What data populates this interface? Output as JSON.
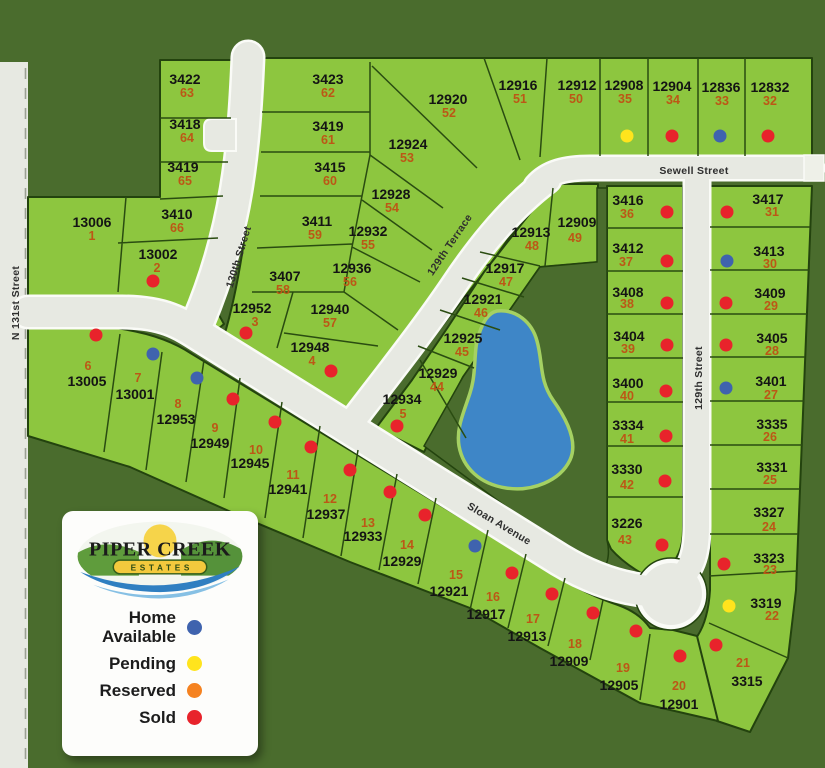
{
  "legend": {
    "brand_top": "PIPER CREEK",
    "brand_banner": "ESTATES",
    "items": [
      {
        "label": "Home Available",
        "status": "home_available",
        "color": "#3f63ae"
      },
      {
        "label": "Pending",
        "status": "pending",
        "color": "#ffe41d"
      },
      {
        "label": "Reserved",
        "status": "reserved",
        "color": "#f58220"
      },
      {
        "label": "Sold",
        "status": "sold",
        "color": "#e8232b"
      }
    ]
  },
  "map": {
    "background_color": "#4a6c2d",
    "lot_color": "#8dc63f",
    "road_color": "#e7e9e2",
    "road_edge_color": "#fafbf7",
    "pond_color": "#3e86c7",
    "address_color": "#141414",
    "lot_number_color": "#bc5716",
    "status_colors": {
      "home_available": "#3f63ae",
      "pending": "#ffe41d",
      "reserved": "#f58220",
      "sold": "#e8232b"
    },
    "streets": [
      {
        "name": "N 131st Street",
        "x": 16,
        "y": 303,
        "rotate": -90
      },
      {
        "name": "130th Street",
        "x": 239,
        "y": 257,
        "rotate": -73
      },
      {
        "name": "129th Terrace",
        "x": 450,
        "y": 245,
        "rotate": -56
      },
      {
        "name": "Sewell Street",
        "x": 694,
        "y": 171,
        "rotate": 0
      },
      {
        "name": "129th Street",
        "x": 699,
        "y": 378,
        "rotate": -90
      },
      {
        "name": "Sloan Avenue",
        "x": 499,
        "y": 524,
        "rotate": 31
      }
    ],
    "lots": [
      {
        "address": "3422",
        "lot": "63",
        "status": null,
        "ax": 185,
        "ay": 79,
        "nx": 187,
        "ny": 93
      },
      {
        "address": "3418",
        "lot": "64",
        "status": null,
        "ax": 185,
        "ay": 124,
        "nx": 187,
        "ny": 138
      },
      {
        "address": "3419",
        "lot": "65",
        "status": null,
        "ax": 183,
        "ay": 167,
        "nx": 185,
        "ny": 181
      },
      {
        "address": "3410",
        "lot": "66",
        "status": null,
        "ax": 177,
        "ay": 214,
        "nx": 177,
        "ny": 228
      },
      {
        "address": "13006",
        "lot": "1",
        "status": null,
        "ax": 92,
        "ay": 222,
        "nx": 92,
        "ny": 236
      },
      {
        "address": "13002",
        "lot": "2",
        "status": "sold",
        "ax": 158,
        "ay": 254,
        "nx": 157,
        "ny": 268,
        "dx": 153,
        "dy": 281
      },
      {
        "address": "3423",
        "lot": "62",
        "status": null,
        "ax": 328,
        "ay": 79,
        "nx": 328,
        "ny": 93
      },
      {
        "address": "3419",
        "lot": "61",
        "status": null,
        "ax": 328,
        "ay": 126,
        "nx": 328,
        "ny": 140
      },
      {
        "address": "3415",
        "lot": "60",
        "status": null,
        "ax": 330,
        "ay": 167,
        "nx": 330,
        "ny": 181
      },
      {
        "address": "3411",
        "lot": "59",
        "status": null,
        "ax": 317,
        "ay": 221,
        "nx": 315,
        "ny": 235
      },
      {
        "address": "3407",
        "lot": "58",
        "status": null,
        "ax": 285,
        "ay": 276,
        "nx": 283,
        "ny": 290
      },
      {
        "address": "12952",
        "lot": "3",
        "status": "sold",
        "ax": 252,
        "ay": 308,
        "nx": 255,
        "ny": 322,
        "dx": 246,
        "dy": 333
      },
      {
        "address": "12940",
        "lot": "57",
        "status": null,
        "ax": 330,
        "ay": 309,
        "nx": 330,
        "ny": 323
      },
      {
        "address": "12948",
        "lot": "4",
        "status": "sold",
        "ax": 310,
        "ay": 347,
        "nx": 312,
        "ny": 361,
        "dx": 331,
        "dy": 371
      },
      {
        "address": "12936",
        "lot": "56",
        "status": null,
        "ax": 352,
        "ay": 268,
        "nx": 350,
        "ny": 282
      },
      {
        "address": "12932",
        "lot": "55",
        "status": null,
        "ax": 368,
        "ay": 231,
        "nx": 368,
        "ny": 245
      },
      {
        "address": "12928",
        "lot": "54",
        "status": null,
        "ax": 391,
        "ay": 194,
        "nx": 392,
        "ny": 208
      },
      {
        "address": "12924",
        "lot": "53",
        "status": null,
        "ax": 408,
        "ay": 144,
        "nx": 407,
        "ny": 158
      },
      {
        "address": "12920",
        "lot": "52",
        "status": null,
        "ax": 448,
        "ay": 99,
        "nx": 449,
        "ny": 113
      },
      {
        "address": "12916",
        "lot": "51",
        "status": null,
        "ax": 518,
        "ay": 85,
        "nx": 520,
        "ny": 99
      },
      {
        "address": "12912",
        "lot": "50",
        "status": null,
        "ax": 577,
        "ay": 85,
        "nx": 576,
        "ny": 99
      },
      {
        "address": "12908",
        "lot": "35",
        "status": "pending",
        "ax": 624,
        "ay": 85,
        "nx": 625,
        "ny": 99,
        "dx": 627,
        "dy": 136
      },
      {
        "address": "12904",
        "lot": "34",
        "status": "sold",
        "ax": 672,
        "ay": 86,
        "nx": 673,
        "ny": 100,
        "dx": 672,
        "dy": 136
      },
      {
        "address": "12836",
        "lot": "33",
        "status": "home_available",
        "ax": 721,
        "ay": 87,
        "nx": 722,
        "ny": 101,
        "dx": 720,
        "dy": 136
      },
      {
        "address": "12832",
        "lot": "32",
        "status": "sold",
        "ax": 770,
        "ay": 87,
        "nx": 770,
        "ny": 101,
        "dx": 768,
        "dy": 136
      },
      {
        "address": "12913",
        "lot": "48",
        "status": null,
        "ax": 531,
        "ay": 232,
        "nx": 532,
        "ny": 246
      },
      {
        "address": "12909",
        "lot": "49",
        "status": null,
        "ax": 577,
        "ay": 222,
        "nx": 575,
        "ny": 238
      },
      {
        "address": "12917",
        "lot": "47",
        "status": null,
        "ax": 505,
        "ay": 268,
        "nx": 506,
        "ny": 282
      },
      {
        "address": "12921",
        "lot": "46",
        "status": null,
        "ax": 483,
        "ay": 299,
        "nx": 481,
        "ny": 313
      },
      {
        "address": "12925",
        "lot": "45",
        "status": null,
        "ax": 463,
        "ay": 338,
        "nx": 462,
        "ny": 352
      },
      {
        "address": "12929",
        "lot": "44",
        "status": null,
        "ax": 438,
        "ay": 373,
        "nx": 437,
        "ny": 387
      },
      {
        "address": "12934",
        "lot": "5",
        "status": "sold",
        "ax": 402,
        "ay": 399,
        "nx": 403,
        "ny": 414,
        "dx": 397,
        "dy": 426
      },
      {
        "address": "3416",
        "lot": "36",
        "status": "sold",
        "ax": 628,
        "ay": 200,
        "nx": 627,
        "ny": 214,
        "dx": 667,
        "dy": 212
      },
      {
        "address": "3412",
        "lot": "37",
        "status": "sold",
        "ax": 628,
        "ay": 248,
        "nx": 626,
        "ny": 262,
        "dx": 667,
        "dy": 261
      },
      {
        "address": "3408",
        "lot": "38",
        "status": "sold",
        "ax": 628,
        "ay": 292,
        "nx": 627,
        "ny": 304,
        "dx": 667,
        "dy": 303
      },
      {
        "address": "3404",
        "lot": "39",
        "status": "sold",
        "ax": 629,
        "ay": 336,
        "nx": 628,
        "ny": 349,
        "dx": 667,
        "dy": 345
      },
      {
        "address": "3400",
        "lot": "40",
        "status": "sold",
        "ax": 628,
        "ay": 383,
        "nx": 627,
        "ny": 396,
        "dx": 666,
        "dy": 391
      },
      {
        "address": "3334",
        "lot": "41",
        "status": "sold",
        "ax": 628,
        "ay": 425,
        "nx": 627,
        "ny": 439,
        "dx": 666,
        "dy": 436
      },
      {
        "address": "3330",
        "lot": "42",
        "status": "sold",
        "ax": 627,
        "ay": 469,
        "nx": 627,
        "ny": 485,
        "dx": 665,
        "dy": 481
      },
      {
        "address": "3226",
        "lot": "43",
        "status": "sold",
        "ax": 627,
        "ay": 523,
        "nx": 625,
        "ny": 540,
        "dx": 662,
        "dy": 545
      },
      {
        "address": "3417",
        "lot": "31",
        "status": "sold",
        "ax": 768,
        "ay": 199,
        "nx": 772,
        "ny": 212,
        "dx": 727,
        "dy": 212
      },
      {
        "address": "3413",
        "lot": "30",
        "status": "home_available",
        "ax": 769,
        "ay": 251,
        "nx": 770,
        "ny": 264,
        "dx": 727,
        "dy": 261
      },
      {
        "address": "3409",
        "lot": "29",
        "status": "sold",
        "ax": 770,
        "ay": 293,
        "nx": 771,
        "ny": 306,
        "dx": 726,
        "dy": 303
      },
      {
        "address": "3405",
        "lot": "28",
        "status": "sold",
        "ax": 772,
        "ay": 338,
        "nx": 772,
        "ny": 351,
        "dx": 726,
        "dy": 345
      },
      {
        "address": "3401",
        "lot": "27",
        "status": "home_available",
        "ax": 771,
        "ay": 381,
        "nx": 771,
        "ny": 395,
        "dx": 726,
        "dy": 388
      },
      {
        "address": "3335",
        "lot": "26",
        "status": null,
        "ax": 772,
        "ay": 424,
        "nx": 770,
        "ny": 437
      },
      {
        "address": "3331",
        "lot": "25",
        "status": null,
        "ax": 772,
        "ay": 467,
        "nx": 770,
        "ny": 480
      },
      {
        "address": "3327",
        "lot": "24",
        "status": null,
        "ax": 769,
        "ay": 512,
        "nx": 769,
        "ny": 527
      },
      {
        "address": "3323",
        "lot": "23",
        "status": "sold",
        "ax": 769,
        "ay": 558,
        "nx": 770,
        "ny": 570,
        "dx": 724,
        "dy": 564
      },
      {
        "address": "3319",
        "lot": "22",
        "status": "pending",
        "ax": 766,
        "ay": 603,
        "nx": 772,
        "ny": 616,
        "dx": 729,
        "dy": 606
      },
      {
        "address": "3315",
        "lot": "21",
        "status": "sold",
        "ax": 747,
        "ay": 681,
        "nx": 743,
        "ny": 663,
        "dx": 716,
        "dy": 645
      },
      {
        "address": "13005",
        "lot": "6",
        "status": "sold",
        "ax": 87,
        "ay": 381,
        "nx": 88,
        "ny": 366,
        "dx": 96,
        "dy": 335
      },
      {
        "address": "13001",
        "lot": "7",
        "status": "home_available",
        "ax": 135,
        "ay": 394,
        "nx": 138,
        "ny": 378,
        "dx": 153,
        "dy": 354
      },
      {
        "address": "12953",
        "lot": "8",
        "status": "home_available",
        "ax": 176,
        "ay": 419,
        "nx": 178,
        "ny": 404,
        "dx": 197,
        "dy": 378
      },
      {
        "address": "12949",
        "lot": "9",
        "status": "sold",
        "ax": 210,
        "ay": 443,
        "nx": 215,
        "ny": 428,
        "dx": 233,
        "dy": 399
      },
      {
        "address": "12945",
        "lot": "10",
        "status": "sold",
        "ax": 250,
        "ay": 463,
        "nx": 256,
        "ny": 450,
        "dx": 275,
        "dy": 422
      },
      {
        "address": "12941",
        "lot": "11",
        "status": "sold",
        "ax": 288,
        "ay": 489,
        "nx": 293,
        "ny": 475,
        "dx": 311,
        "dy": 447
      },
      {
        "address": "12937",
        "lot": "12",
        "status": "sold",
        "ax": 326,
        "ay": 514,
        "nx": 330,
        "ny": 499,
        "dx": 350,
        "dy": 470
      },
      {
        "address": "12933",
        "lot": "13",
        "status": "sold",
        "ax": 363,
        "ay": 536,
        "nx": 368,
        "ny": 523,
        "dx": 390,
        "dy": 492
      },
      {
        "address": "12929",
        "lot": "14",
        "status": "sold",
        "ax": 402,
        "ay": 561,
        "nx": 407,
        "ny": 545,
        "dx": 425,
        "dy": 515
      },
      {
        "address": "12921",
        "lot": "15",
        "status": "home_available",
        "ax": 449,
        "ay": 591,
        "nx": 456,
        "ny": 575,
        "dx": 475,
        "dy": 546
      },
      {
        "address": "12917",
        "lot": "16",
        "status": "sold",
        "ax": 486,
        "ay": 614,
        "nx": 493,
        "ny": 597,
        "dx": 512,
        "dy": 573
      },
      {
        "address": "12913",
        "lot": "17",
        "status": "sold",
        "ax": 527,
        "ay": 636,
        "nx": 533,
        "ny": 619,
        "dx": 552,
        "dy": 594
      },
      {
        "address": "12909",
        "lot": "18",
        "status": "sold",
        "ax": 569,
        "ay": 661,
        "nx": 575,
        "ny": 644,
        "dx": 593,
        "dy": 613
      },
      {
        "address": "12905",
        "lot": "19",
        "status": "sold",
        "ax": 619,
        "ay": 685,
        "nx": 623,
        "ny": 668,
        "dx": 636,
        "dy": 631
      },
      {
        "address": "12901",
        "lot": "20",
        "status": "sold",
        "ax": 679,
        "ay": 704,
        "nx": 679,
        "ny": 686,
        "dx": 680,
        "dy": 656
      }
    ]
  }
}
